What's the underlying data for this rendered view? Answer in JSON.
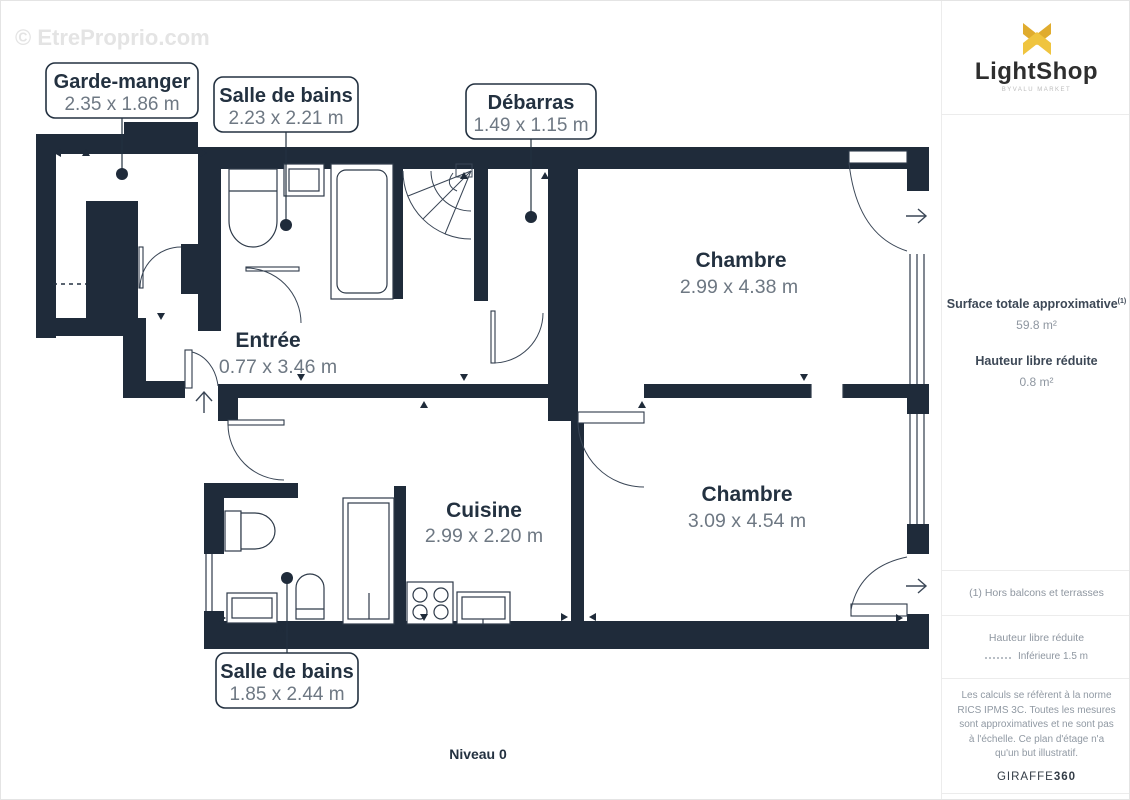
{
  "plan": {
    "watermark": "© EtreProprio.com",
    "level_label": "Niveau 0",
    "rooms": [
      {
        "name": "Garde-manger",
        "dims": "2.35 x 1.86 m",
        "label_style": "boxed"
      },
      {
        "name": "Salle de bains",
        "dims": "2.23 x 2.21 m",
        "label_style": "boxed"
      },
      {
        "name": "Débarras",
        "dims": "1.49 x 1.15 m",
        "label_style": "boxed"
      },
      {
        "name": "Chambre",
        "dims": "2.99 x 4.38 m",
        "label_style": "plain"
      },
      {
        "name": "Entrée",
        "dims": "0.77 x 3.46 m",
        "label_style": "plain"
      },
      {
        "name": "Cuisine",
        "dims": "2.99 x 2.20 m",
        "label_style": "plain"
      },
      {
        "name": "Chambre",
        "dims": "3.09 x 4.54 m",
        "label_style": "plain"
      },
      {
        "name": "Salle de bains",
        "dims": "1.85 x 2.44 m",
        "label_style": "boxed"
      }
    ]
  },
  "sidebar": {
    "brand": {
      "name": "LightShop",
      "tagline": "BYVALU MARKET"
    },
    "surface_label": "Surface totale approximative",
    "surface_note_ref": "(1)",
    "surface_value": "59.8 m²",
    "height_label": "Hauteur libre réduite",
    "height_value": "0.8 m²",
    "footnote": "(1) Hors balcons et terrasses",
    "legend_title": "Hauteur libre réduite",
    "legend_item": "Inférieure 1.5 m",
    "disclaimer": "Les calculs se réfèrent à la norme RICS IPMS 3C. Toutes les mesures sont approximatives et ne sont pas à l'échelle. Ce plan d'étage n'a qu'un but illustratif.",
    "provider": "GIRAFFE",
    "provider_suffix": "360"
  },
  "colors": {
    "wall": "#1f2b3a",
    "accent_gold": "#EABD3B",
    "dim_text": "#6e7883",
    "room_text": "#233140"
  }
}
